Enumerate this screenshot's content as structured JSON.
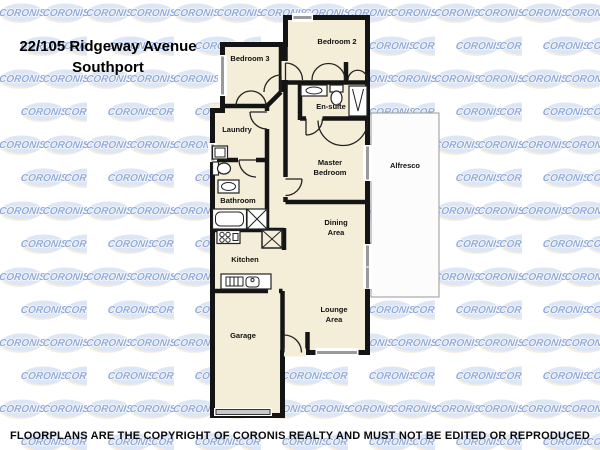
{
  "watermark": {
    "text": "CORONIS",
    "ellipse_color": "#d6e1f3",
    "accent_color": "#edd9b8",
    "text_color": "#7f9bd2"
  },
  "header": {
    "address_line1": "22/105 Ridgeway Avenue",
    "address_line2": "Southport"
  },
  "rooms": {
    "bedroom2": "Bedroom 2",
    "bedroom3": "Bedroom 3",
    "ensuite": "En-suite",
    "laundry": "Laundry",
    "master_line1": "Master",
    "master_line2": "Bedroom",
    "alfresco": "Alfresco",
    "bathroom": "Bathroom",
    "kitchen": "Kitchen",
    "dining_line1": "Dining",
    "dining_line2": "Area",
    "lounge_line1": "Lounge",
    "lounge_line2": "Area",
    "garage": "Garage"
  },
  "footer": {
    "copyright": "FLOORPLANS ARE THE COPYRIGHT OF CORONIS REALTY AND MUST NOT BE EDITED OR REPRODUCED"
  },
  "colors": {
    "floor": "#f4eed9",
    "wall": "#141414",
    "window_glass": "#9a9a9a",
    "alfresco_fill": "#fcfcfc",
    "garage_door": "#c8c8c8",
    "title_text": "#000000",
    "footer_text": "#0a0a0a"
  }
}
